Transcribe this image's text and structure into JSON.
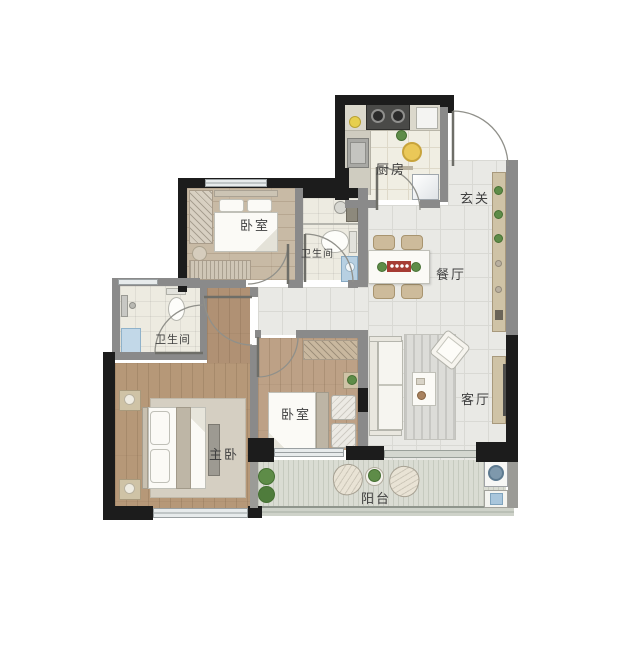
{
  "plan": {
    "type": "apartment-floor-plan",
    "labels": {
      "kitchen": "厨房",
      "entrance": "玄关",
      "dining": "餐厅",
      "living": "客厅",
      "bedroom_top": "卧室",
      "bedroom_mid": "卧室",
      "master_bedroom": "主卧",
      "bathroom_main": "卫生间",
      "bathroom_left": "卫生间",
      "balcony": "阳台"
    },
    "palette": {
      "wall_black": "#1c1c1c",
      "wall_gray": "#8a8a8a",
      "tile_floor": "#e9e9e5",
      "wood_light": "#c8baa5",
      "wood_warm": "#b69878",
      "balcony_floor": "#dadcd3",
      "cabinet_tan": "#cfc3a6",
      "accent_red": "#a63c34",
      "plant_green": "#5e8c48",
      "water_blue": "#aac8de",
      "stove_dark": "#4a4a48",
      "label_text": "#3f3f3f"
    }
  }
}
